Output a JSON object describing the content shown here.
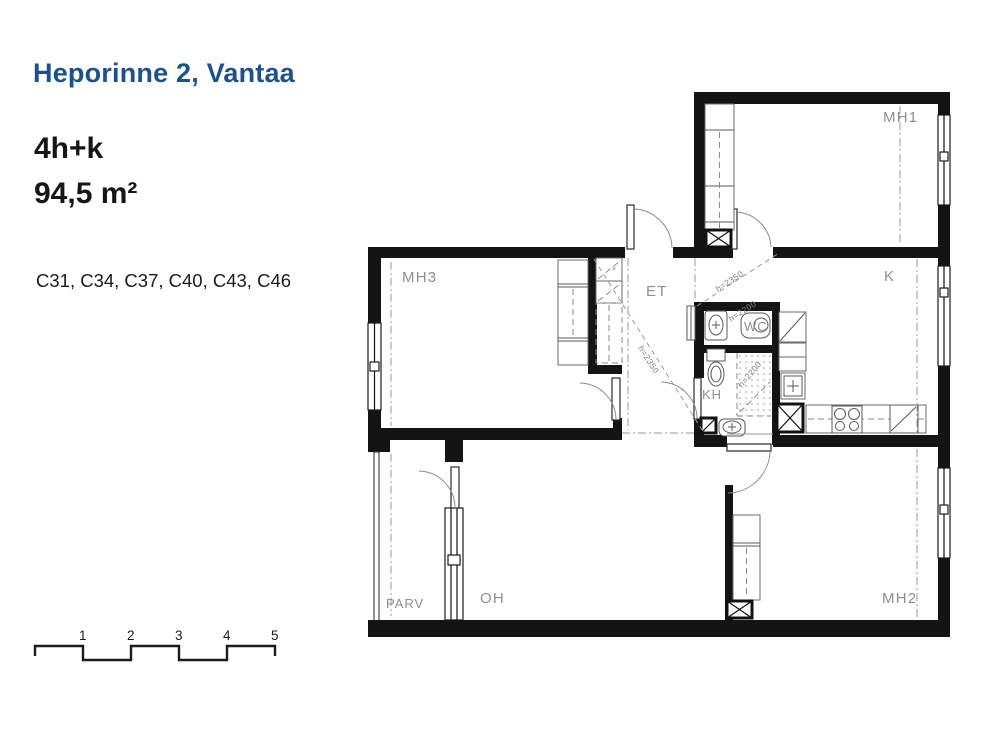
{
  "panel": {
    "title": "Heporinne 2, Vantaa",
    "apartment_type": "4h+k",
    "area": "94,5 m²",
    "apartment_numbers": "C31, C34, C37, C40, C43, C46"
  },
  "floorplan": {
    "rooms": {
      "mh1": "MH1",
      "mh2": "MH2",
      "mh3": "MH3",
      "et": "ET",
      "k": "K",
      "kh": "KH",
      "wc": "WC",
      "oh": "OH",
      "parv": "PARV"
    },
    "height_labels": {
      "corridor": "h=2350",
      "et_diagonal": "h=2350",
      "wc": "h=2200",
      "kh": "h=2200"
    }
  },
  "scale_bar": {
    "numbers": [
      "1",
      "2",
      "3",
      "4",
      "5"
    ]
  },
  "colors": {
    "title_blue": "#1A5291",
    "wall_black": "#141414",
    "label_gray": "#8F8F8F"
  }
}
